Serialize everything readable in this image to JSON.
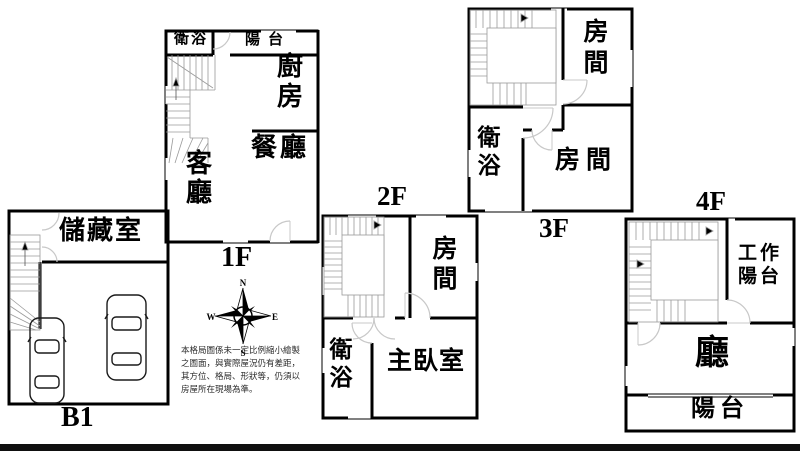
{
  "floors": {
    "b1": {
      "name": "B1",
      "rooms": {
        "storage": "儲藏室"
      }
    },
    "f1": {
      "name": "1F",
      "rooms": {
        "bath": "衛浴",
        "balcony": "陽台",
        "kitchen": "廚房",
        "dining": "餐廳",
        "living": "客廳"
      }
    },
    "f2": {
      "name": "2F",
      "rooms": {
        "room": "房間",
        "bath": "衛浴",
        "master": "主臥室"
      }
    },
    "f3": {
      "name": "3F",
      "rooms": {
        "room_top": "房間",
        "bath": "衛浴",
        "room_bottom": "房間"
      }
    },
    "f4": {
      "name": "4F",
      "rooms": {
        "work_balcony": "工作陽台",
        "hall": "廳",
        "balcony": "陽台"
      }
    }
  },
  "compass": {
    "icon": "compass-rose",
    "n": "N",
    "e": "E",
    "s": "S",
    "w": "W"
  },
  "disclaimer": {
    "line1": "本格局圖係未一定比例縮小繪製",
    "line2": "之圖面，與實際屋況仍有差距，",
    "line3": "其方位、格局、形狀等，仍須以",
    "line4": "房屋所在現場為準。"
  },
  "icons": {
    "car": "car-top-view-icon",
    "stairs": "staircase-icon",
    "door": "door-swing-arc"
  },
  "colors": {
    "wall": "#000000",
    "background": "#ffffff",
    "footer_bar": "#0f0f0f",
    "stair_line": "#9a9a9a",
    "door_arc": "#c8c8c8"
  }
}
